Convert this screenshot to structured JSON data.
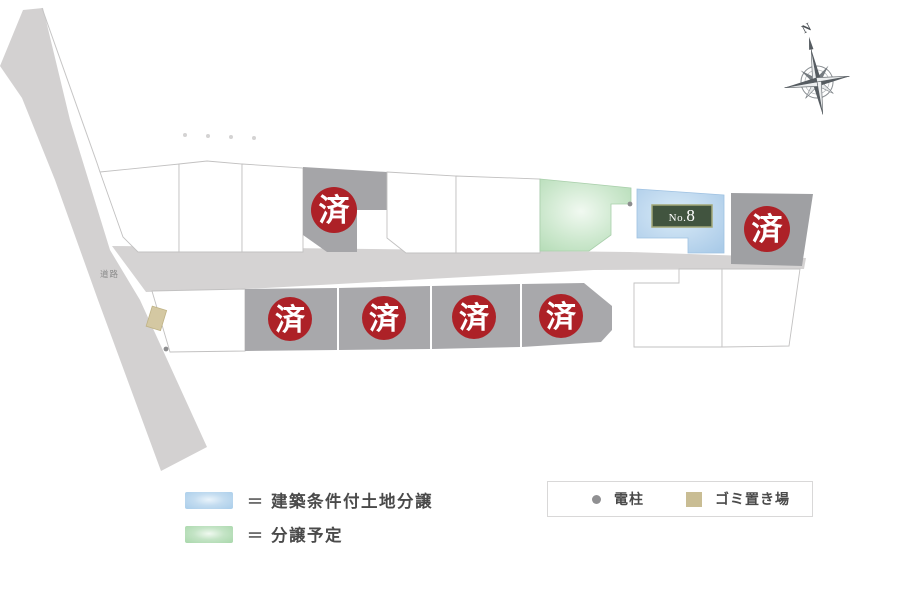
{
  "map": {
    "road_label": "道路",
    "compass": {
      "north_label": "N"
    },
    "sold_badge_text": "済",
    "lot_no8": {
      "prefix": "No.",
      "number": "8"
    },
    "colors": {
      "sold_badge_red": "#ad2127",
      "sold_lot_gray": "#a5a5a8",
      "road_gray": "#d5d3d3",
      "conditional_lot_blue": "#aed0ec",
      "planned_lot_green": "#b5dcb7",
      "no8_label_green": "#41543f",
      "garbage_tan": "#d4c8a2"
    }
  },
  "legend": {
    "items": [
      {
        "swatch": "blue",
        "eq": "＝",
        "label": "建築条件付土地分譲",
        "color": "#a9cdea"
      },
      {
        "swatch": "green",
        "eq": "＝",
        "label": "分譲予定",
        "color": "#a8d7aa"
      }
    ],
    "markers": [
      {
        "symbol": "dot",
        "label": "電柱",
        "color": "#909092"
      },
      {
        "symbol": "square",
        "label": "ゴミ置き場",
        "color": "#c9bd94"
      }
    ]
  }
}
